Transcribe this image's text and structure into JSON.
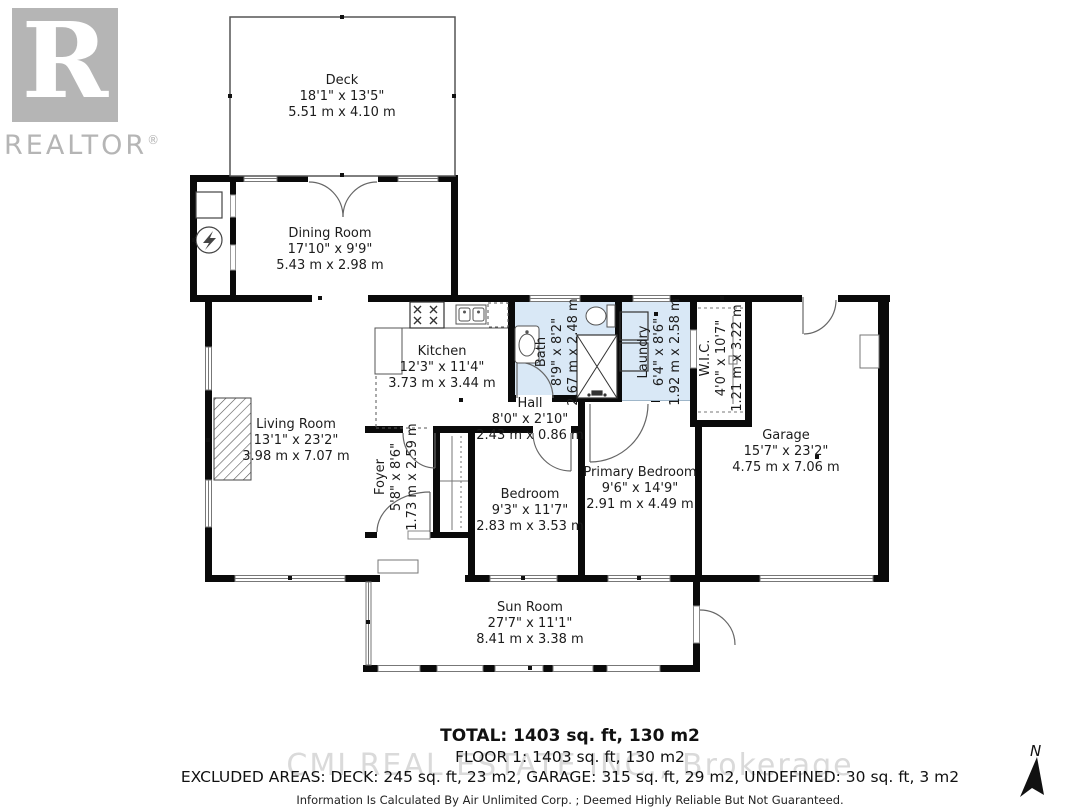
{
  "branding": {
    "logo_r": "R",
    "logo_word": "REALTOR",
    "registered": "®"
  },
  "rooms": {
    "deck": {
      "name": "Deck",
      "imperial": "18'1\" x 13'5\"",
      "metric": "5.51 m x 4.10 m"
    },
    "dining": {
      "name": "Dining Room",
      "imperial": "17'10\" x 9'9\"",
      "metric": "5.43 m x 2.98 m"
    },
    "kitchen": {
      "name": "Kitchen",
      "imperial": "12'3\" x 11'4\"",
      "metric": "3.73 m x 3.44 m"
    },
    "bath": {
      "name": "Bath",
      "imperial": "8'9\" x 8'2\"",
      "metric": "2.67 m x 2.48 m"
    },
    "laundry": {
      "name": "Laundry",
      "imperial": "6'4\" x 8'6\"",
      "metric": "1.92 m x 2.58 m"
    },
    "wic": {
      "name": "W.I.C.",
      "imperial": "4'0\" x 10'7\"",
      "metric": "1.21 m x 3.22 m"
    },
    "hall": {
      "name": "Hall",
      "imperial": "8'0\" x 2'10\"",
      "metric": "2.43 m x 0.86 m"
    },
    "living": {
      "name": "Living Room",
      "imperial": "13'1\" x 23'2\"",
      "metric": "3.98 m x 7.07 m"
    },
    "foyer": {
      "name": "Foyer",
      "imperial": "5'8\" x 8'6\"",
      "metric": "1.73 m x 2.59 m"
    },
    "bedroom": {
      "name": "Bedroom",
      "imperial": "9'3\" x 11'7\"",
      "metric": "2.83 m x 3.53 m"
    },
    "primary": {
      "name": "Primary Bedroom",
      "imperial": "9'6\" x 14'9\"",
      "metric": "2.91 m x 4.49 m"
    },
    "garage": {
      "name": "Garage",
      "imperial": "15'7\" x 23'2\"",
      "metric": "4.75 m x 7.06 m"
    },
    "sunroom": {
      "name": "Sun Room",
      "imperial": "27'7\" x 11'1\"",
      "metric": "8.41 m x 3.38 m"
    }
  },
  "footer": {
    "total": "TOTAL: 1403 sq. ft, 130 m2",
    "floor": "FLOOR 1: 1403 sq. ft, 130 m2",
    "excluded": "EXCLUDED AREAS: DECK: 245 sq. ft, 23 m2, GARAGE: 315 sq. ft, 29 m2, UNDEFINED: 30 sq. ft, 3 m2",
    "disclaimer": "Information Is Calculated By Air Unlimited Corp. ; Deemed Highly Reliable But Not Guaranteed.",
    "watermark": "CMI REAL ESTATE INC., Brokerage"
  },
  "compass": {
    "label": "N"
  },
  "colors": {
    "wall": "#0a0a0a",
    "wet_room_fill": "#d9e8f6",
    "logo_gray": "#b5b5b5",
    "watermark_gray": "#dadada"
  }
}
